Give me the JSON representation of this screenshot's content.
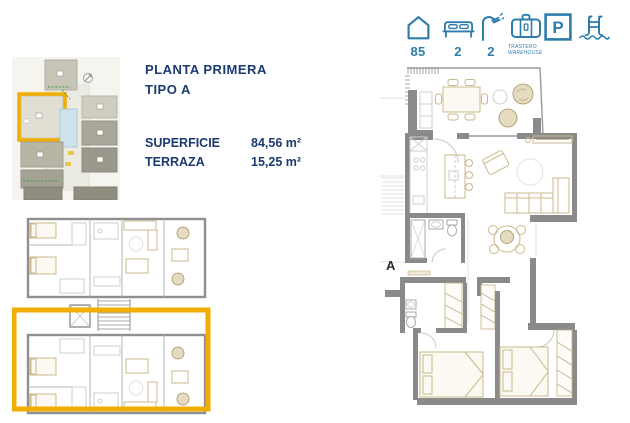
{
  "colors": {
    "navy": "#1b3a70",
    "teal": "#2e7cab",
    "highlight_yellow": "#f2ae00",
    "wall_gray": "#8a8a8a",
    "pool_blue": "#cfe3ea"
  },
  "stats_bar": {
    "area": {
      "icon": "house-icon",
      "value": "85"
    },
    "bedrooms": {
      "icon": "bed-icon",
      "value": "2"
    },
    "bathrooms": {
      "icon": "shower-icon",
      "value": "2"
    },
    "storage": {
      "icon": "suitcase-icon",
      "line1": "TRASTERO",
      "line2": "WAREHOUSE"
    },
    "parking": {
      "icon": "parking-icon",
      "glyph": "P"
    },
    "pool": {
      "icon": "pool-icon"
    }
  },
  "title": {
    "line1": "PLANTA PRIMERA",
    "line2": "TIPO A"
  },
  "areas": [
    {
      "label": "SUPERFICIE",
      "value": "84,56 m²"
    },
    {
      "label": "TERRAZA",
      "value": "15,25 m²"
    }
  ],
  "detail_plan": {
    "unit_label": "A"
  }
}
